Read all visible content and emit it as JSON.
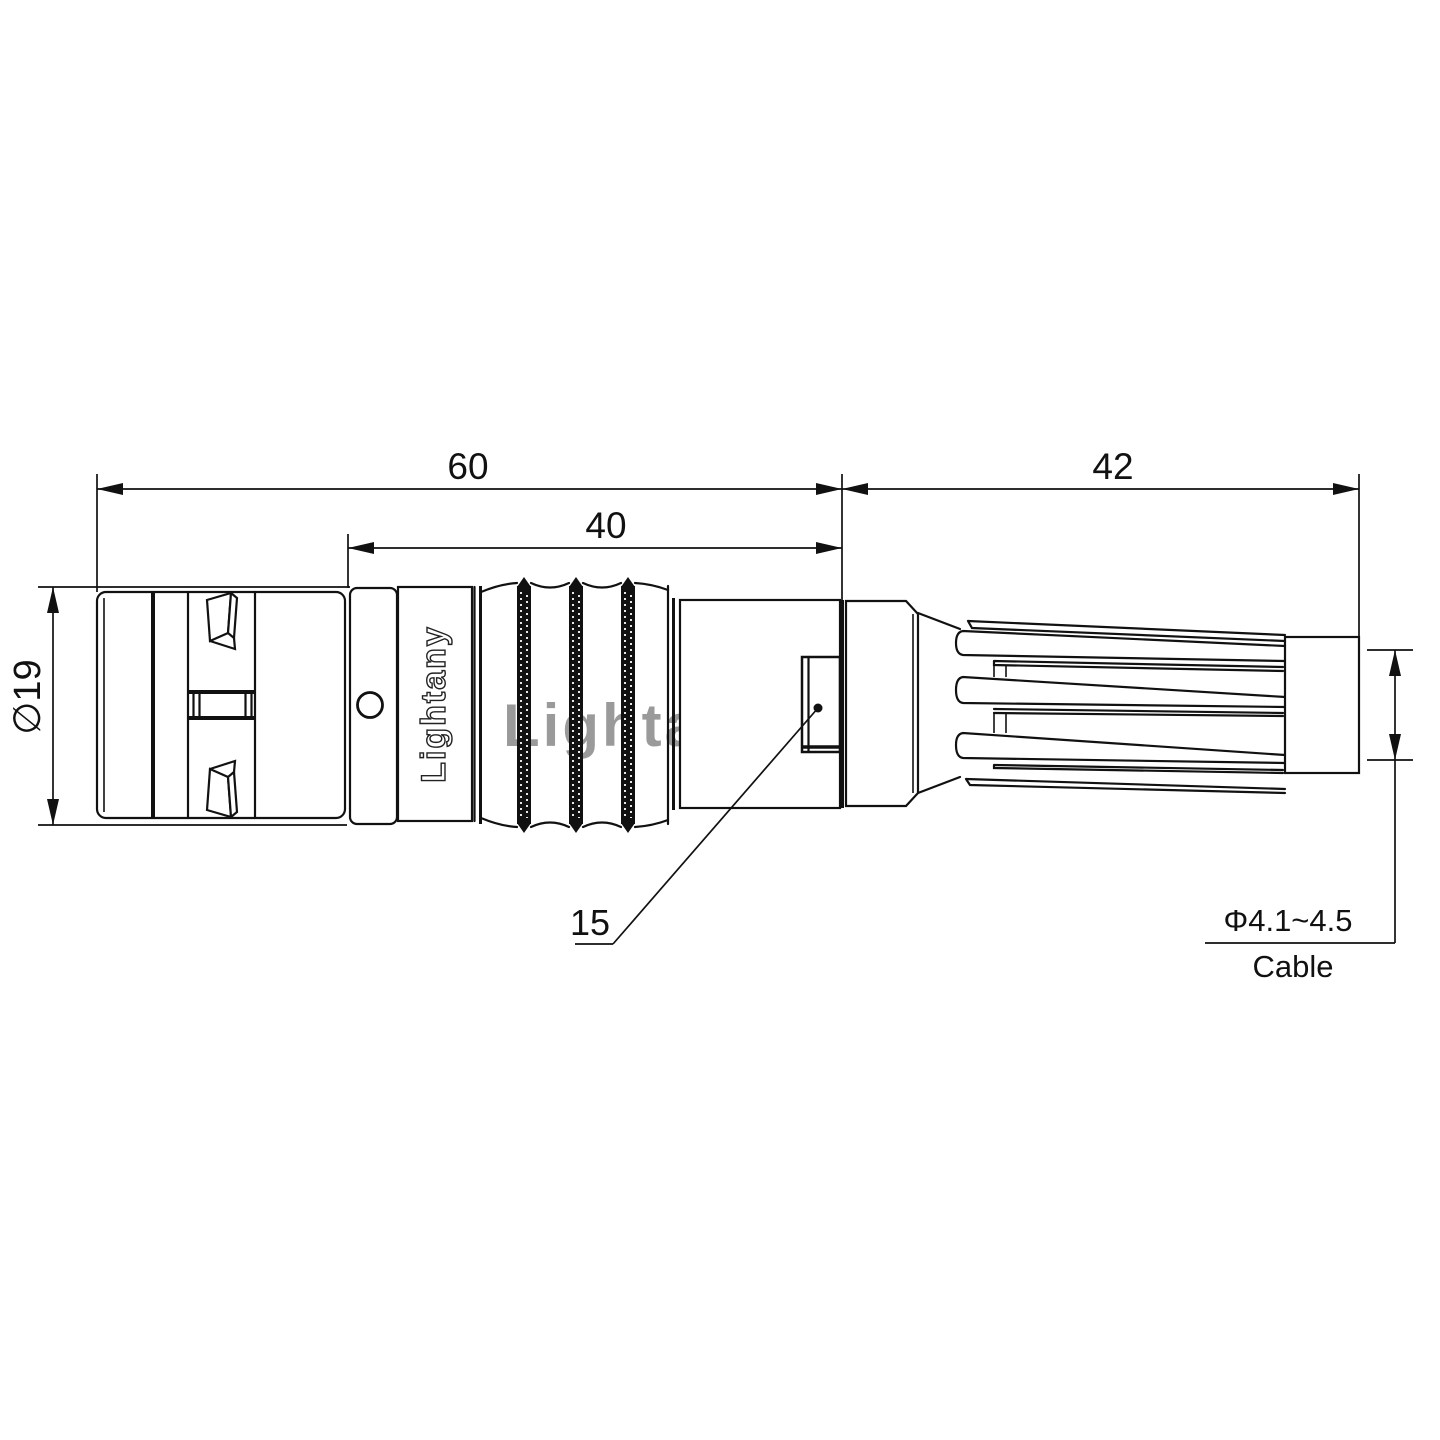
{
  "drawing": {
    "dimensions": {
      "overall_length": "60",
      "front_body_length": "40",
      "rear_length": "42",
      "outer_diameter": "∅19",
      "window_callout": "15",
      "cable_diameter_range": "Φ4.1~4.5",
      "cable_caption": "Cable"
    },
    "branding": {
      "engraved_text": "Lightany",
      "watermark_text": "Lightany"
    },
    "colors": {
      "line": "#111111",
      "watermark": "#dd7b7b"
    }
  }
}
